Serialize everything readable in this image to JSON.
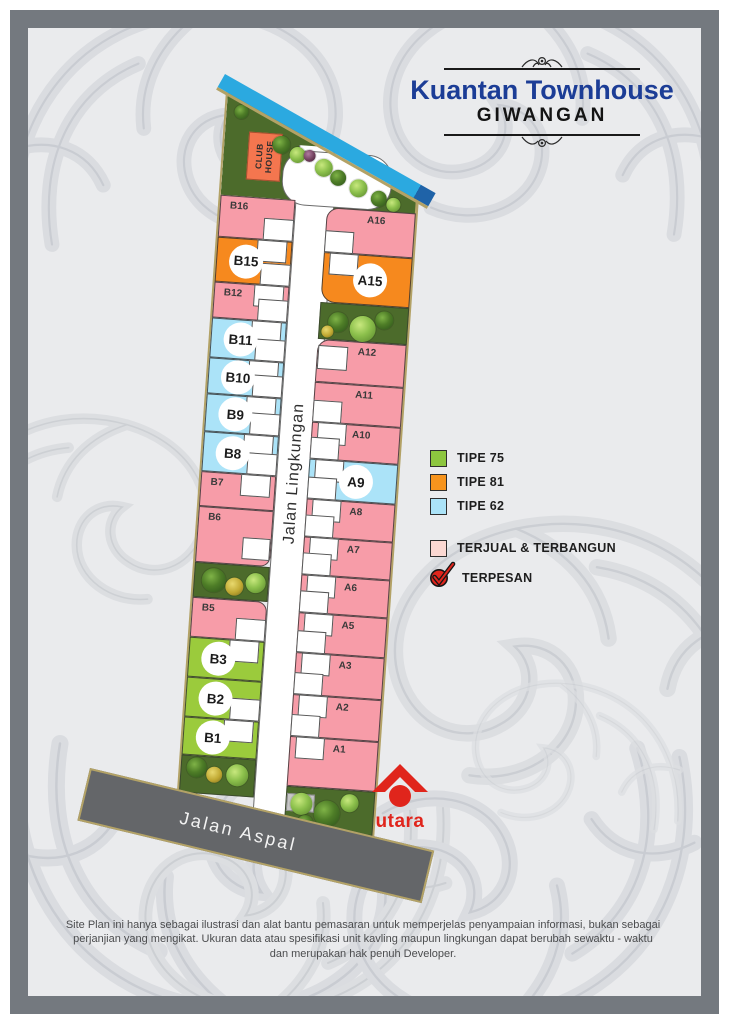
{
  "header": {
    "title": "Kuantan Townhouse",
    "subtitle": "GIWANGAN"
  },
  "legend": {
    "types": [
      {
        "id": "tipe75",
        "label": "TIPE 75",
        "swatch": "#8DC63F"
      },
      {
        "id": "tipe81",
        "label": "TIPE 81",
        "swatch": "#F7941D"
      },
      {
        "id": "tipe62",
        "label": "TIPE 62",
        "swatch": "#ABE3F8"
      }
    ],
    "status": [
      {
        "id": "sold",
        "label": "TERJUAL & TERBANGUN",
        "swatch": "#FBD8D2"
      },
      {
        "id": "reserved",
        "label": "TERPESAN",
        "swatch": "#E0251C"
      }
    ]
  },
  "siteplan": {
    "club_house_label": "CLUB HOUSE",
    "inner_road_label": "Jalan Lingkungan",
    "outer_road_label": "Jalan Aspal",
    "north_label": "utara",
    "lot_colors": {
      "sold": "#F79CA8",
      "tipe75": "#9BCB3C",
      "tipe81": "#F6891E",
      "tipe62": "#ABE3F8"
    },
    "lots": {
      "left": [
        {
          "id": "B16",
          "type": "sold",
          "marker": "plain"
        },
        {
          "id": "B15",
          "type": "tipe81",
          "marker": "circle"
        },
        {
          "id": "B12",
          "type": "sold",
          "marker": "plain"
        },
        {
          "id": "B11",
          "type": "tipe62",
          "marker": "circle"
        },
        {
          "id": "B10",
          "type": "tipe62",
          "marker": "circle"
        },
        {
          "id": "B9",
          "type": "tipe62",
          "marker": "circle"
        },
        {
          "id": "B8",
          "type": "tipe62",
          "marker": "circle"
        },
        {
          "id": "B7",
          "type": "sold",
          "marker": "plain"
        },
        {
          "id": "B6",
          "type": "sold",
          "marker": "plain"
        },
        {
          "id": "B5",
          "type": "sold",
          "marker": "plain"
        },
        {
          "id": "B3",
          "type": "tipe75",
          "marker": "circle"
        },
        {
          "id": "B2",
          "type": "tipe75",
          "marker": "circle"
        },
        {
          "id": "B1",
          "type": "tipe75",
          "marker": "circle"
        }
      ],
      "right": [
        {
          "id": "A16",
          "type": "sold",
          "marker": "plain"
        },
        {
          "id": "A15",
          "type": "tipe81",
          "marker": "circle"
        },
        {
          "id": "A12",
          "type": "sold",
          "marker": "plain"
        },
        {
          "id": "A11",
          "type": "sold",
          "marker": "plain"
        },
        {
          "id": "A10",
          "type": "sold",
          "marker": "plain"
        },
        {
          "id": "A9",
          "type": "tipe62",
          "marker": "circle"
        },
        {
          "id": "A8",
          "type": "sold",
          "marker": "plain"
        },
        {
          "id": "A7",
          "type": "sold",
          "marker": "plain"
        },
        {
          "id": "A6",
          "type": "sold",
          "marker": "plain"
        },
        {
          "id": "A5",
          "type": "sold",
          "marker": "plain"
        },
        {
          "id": "A3",
          "type": "sold",
          "marker": "plain"
        },
        {
          "id": "A2",
          "type": "sold",
          "marker": "plain"
        },
        {
          "id": "A1",
          "type": "sold",
          "marker": "plain"
        }
      ]
    }
  },
  "footer": {
    "disclaimer": "Site Plan ini hanya sebagai ilustrasi dan alat bantu pemasaran untuk memperjelas penyampaian informasi, bukan sebagai perjanjian yang mengikat. Ukuran data atau spesifikasi unit kavling maupun lingkungan dapat berubah sewaktu - waktu dan merupakan hak penuh Developer."
  }
}
